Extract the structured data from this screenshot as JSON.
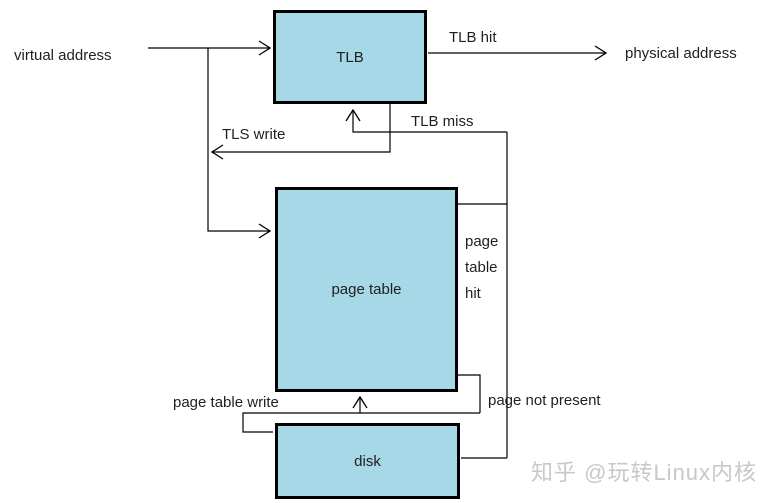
{
  "boxes": {
    "tlb": {
      "label": "TLB"
    },
    "page_table": {
      "label": "page table"
    },
    "disk": {
      "label": "disk"
    }
  },
  "labels": {
    "virtual_address": "virtual address",
    "tlb_hit": "TLB hit",
    "physical_address": "physical address",
    "tls_write": "TLS write",
    "tlb_miss": "TLB miss",
    "page_table_hit_lines": [
      "page",
      "table",
      "hit"
    ],
    "page_table_write": "page table write",
    "page_not_present": "page not present"
  },
  "watermark": {
    "text": "知乎 @玩转Linux内核"
  },
  "colors": {
    "background": "#ffffff",
    "box_fill": "#a6d8e7",
    "box_border": "#000000",
    "line": "#000000",
    "text": "#1f1f1f",
    "watermark": "#c8c8c8"
  }
}
